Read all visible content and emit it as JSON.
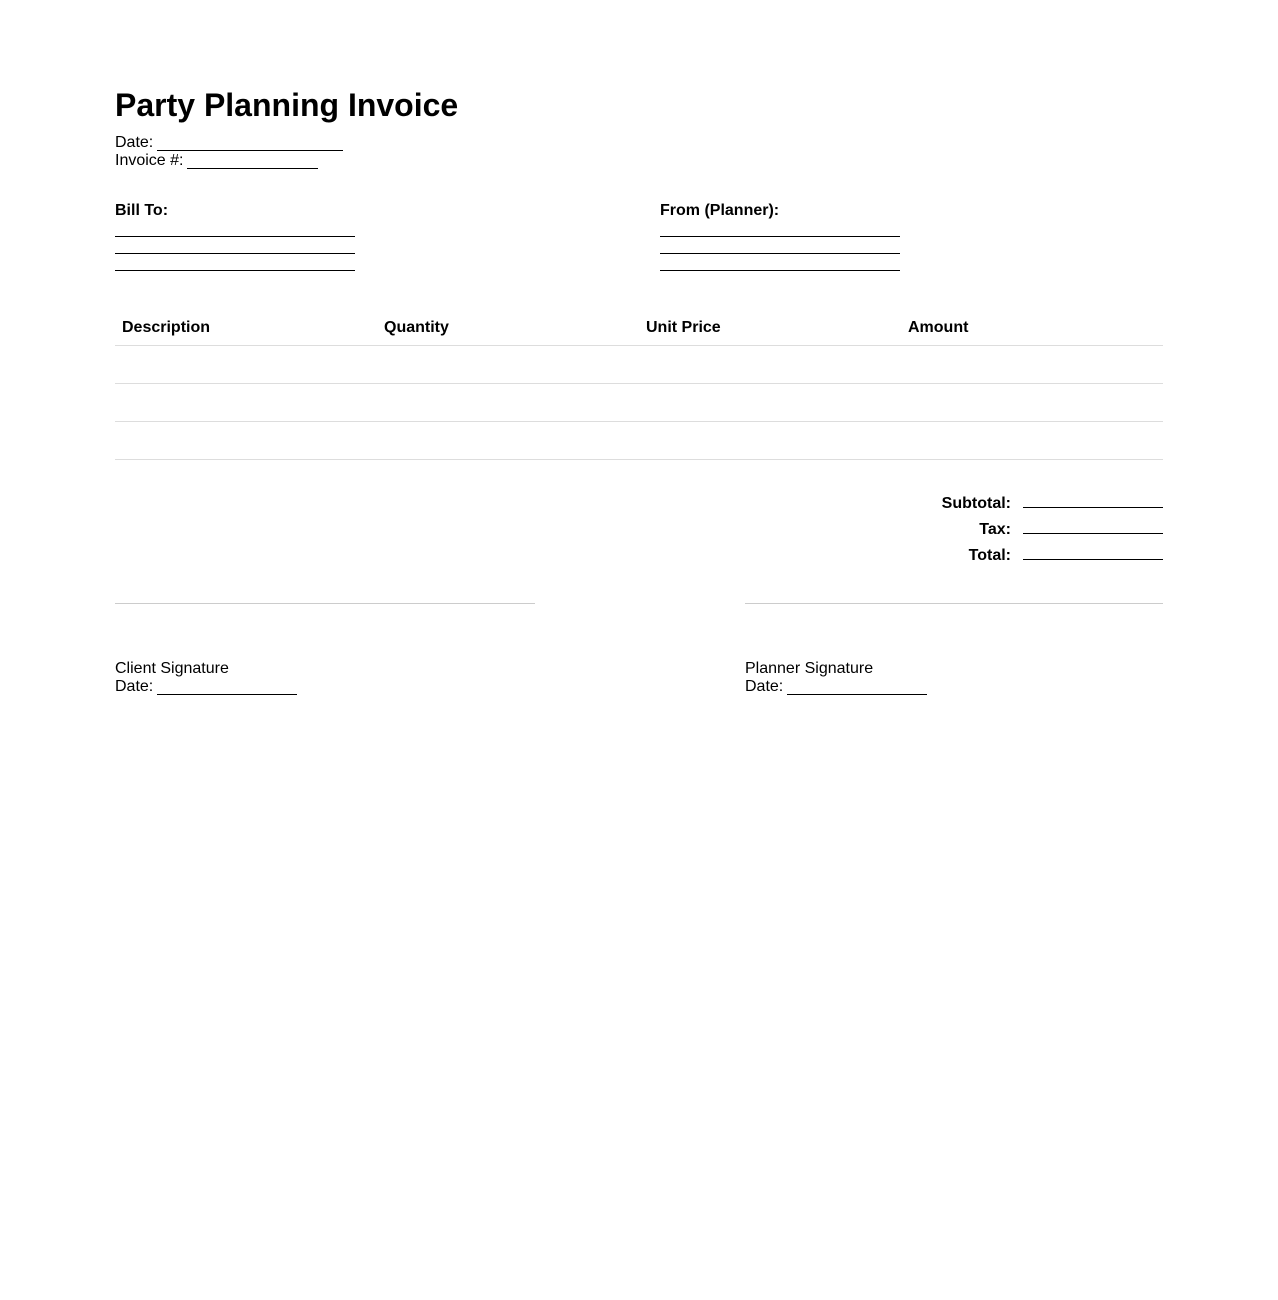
{
  "document": {
    "title": "Party Planning Invoice",
    "meta": {
      "date_label": "Date:",
      "invoice_number_label": "Invoice #:"
    },
    "parties": {
      "bill_to": {
        "label": "Bill To:",
        "blank_line_count": 3
      },
      "from_planner": {
        "label": "From (Planner):",
        "blank_line_count": 3
      }
    },
    "items_table": {
      "headers": [
        "Description",
        "Quantity",
        "Unit Price",
        "Amount"
      ],
      "empty_row_count": 3
    },
    "totals": {
      "subtotal_label": "Subtotal:",
      "tax_label": "Tax:",
      "total_label": "Total:"
    },
    "signatures": {
      "client": {
        "label": "Client Signature",
        "date_label": "Date:"
      },
      "planner": {
        "label": "Planner Signature",
        "date_label": "Date:"
      }
    }
  },
  "colors": {
    "text": "#000000",
    "background": "#ffffff",
    "fill_line": "#000000",
    "table_row_line": "#dddddd",
    "signature_divider": "#cccccc"
  }
}
